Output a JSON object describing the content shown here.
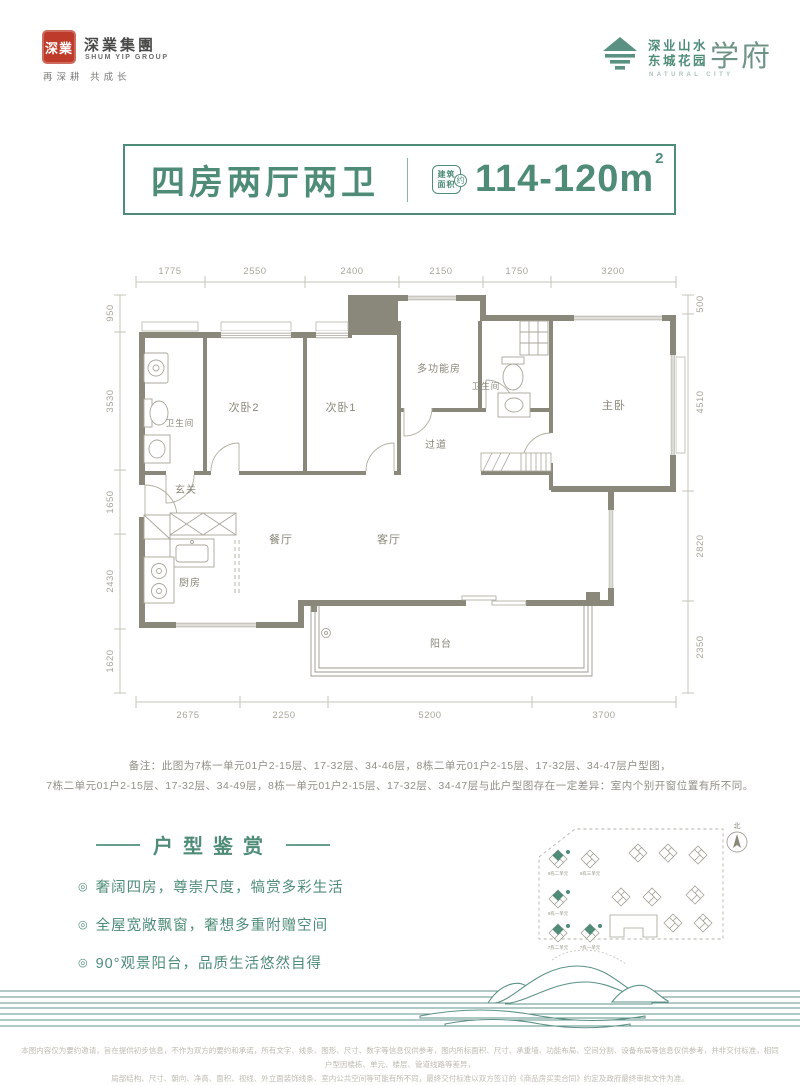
{
  "header": {
    "seal": "深業",
    "group_cn": "深業集團",
    "group_en": "SHUM YIP GROUP",
    "slogan": "再深耕  共成长",
    "project_line1": "深业山水",
    "project_line2": "东城花园",
    "project_suffix": "学府",
    "project_en": "NATURAL CITY"
  },
  "banner": {
    "title": "四房两厅两卫",
    "stamp_top": "建筑",
    "stamp_bottom": "面积",
    "stamp_about": "约",
    "area": "114-120m",
    "area_sup": "2"
  },
  "plan": {
    "dims_top": [
      "1775",
      "2550",
      "2400",
      "2150",
      "1750",
      "3200"
    ],
    "dims_left": [
      "950",
      "3530",
      "1650",
      "2430",
      "1620"
    ],
    "dims_right": [
      "500",
      "4510",
      "2820",
      "2350"
    ],
    "dims_bottom": [
      "2675",
      "2250",
      "5200",
      "3700"
    ],
    "rooms": {
      "bath1": "卫生间",
      "bed2": "次卧2",
      "bed1": "次卧1",
      "multi": "多功能房",
      "bath2": "卫生间",
      "master": "主卧",
      "corridor": "过道",
      "foyer": "玄关",
      "dining": "餐厅",
      "living": "客厅",
      "kitchen": "厨房",
      "balcony": "阳台"
    }
  },
  "notes": {
    "label": "备注：",
    "line1": "此图为7栋一单元01户2-15层、17-32层、34-46层，8栋二单元01户2-15层、17-32层、34-47层户型图，",
    "line2": "7栋二单元01户2-15层、17-32层、34-49层，8栋一单元01户2-15层、17-32层、34-47层与此户型图存在一定差异：室内个别开窗位置有所不同。"
  },
  "appreciation": {
    "title": "户型鉴赏",
    "bullets": [
      "奢阔四房，尊崇尺度，犒赏多彩生活",
      "全屋宽敞飘窗，奢想多重附赠空间",
      "90°观景阳台，品质生活悠然自得"
    ]
  },
  "sitemap": {
    "compass": "北",
    "labels": [
      "8栋二单元",
      "8栋三单元",
      "8栋一单元",
      "7栋二单元",
      "7栋一单元"
    ]
  },
  "disclaimer": {
    "line1": "本图内容仅为要约邀请，旨在提供初步信息，不作为双方的要约和承诺，所有文字、线条、图形、尺寸、数字等信息仅供参考，图内所标面积、尺寸、承重墙、功能布局、空间分割、设备布局等信息仅供参考，并非交付标准，相同户型因楼栋、单元、楼层、管道线路等差异，",
    "line2": "局部结构、尺寸、朝向、净高、面积、视线、外立面装饰线条、室内公共空间等可能有所不同，最终交付标准以双方签订的《商品房买卖合同》约定及政府最终审批文件为准。"
  },
  "colors": {
    "accent_green": "#4E8C77",
    "seal_red": "#BE3A2A",
    "wall": "#8A887A"
  }
}
